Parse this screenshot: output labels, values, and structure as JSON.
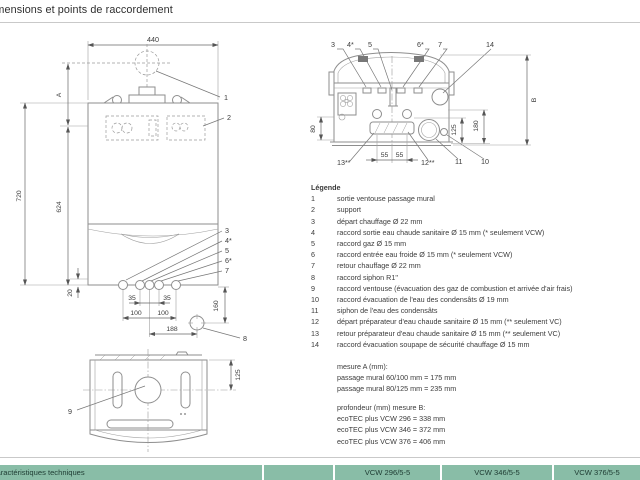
{
  "page": {
    "title": "Dimensions et points de raccordement"
  },
  "legend": {
    "heading": "Légende",
    "items": [
      {
        "num": "1",
        "text": "sortie ventouse passage mural"
      },
      {
        "num": "2",
        "text": "support"
      },
      {
        "num": "3",
        "text": "départ chauffage Ø 22 mm"
      },
      {
        "num": "4",
        "text": "raccord sortie eau chaude sanitaire Ø 15 mm (* seulement VCW)"
      },
      {
        "num": "5",
        "text": "raccord gaz Ø 15 mm"
      },
      {
        "num": "6",
        "text": "raccord entrée eau froide Ø 15 mm (* seulement VCW)"
      },
      {
        "num": "7",
        "text": "retour chauffage Ø 22 mm"
      },
      {
        "num": "8",
        "text": "raccord siphon R1\""
      },
      {
        "num": "9",
        "text": "raccord ventouse (évacuation des gaz de combustion et arrivée d'air frais)"
      },
      {
        "num": "10",
        "text": "raccord évacuation de l'eau des condensâts Ø 19 mm"
      },
      {
        "num": "11",
        "text": "siphon de l'eau des condensâts"
      },
      {
        "num": "12",
        "text": "départ préparateur d'eau chaude sanitaire Ø 15 mm (** seulement VC)"
      },
      {
        "num": "13",
        "text": "retour préparateur d'eau chaude sanitaire Ø 15 mm (** seulement VC)"
      },
      {
        "num": "14",
        "text": "raccord évacuation soupape de sécurité chauffage Ø 15 mm"
      }
    ]
  },
  "notes": {
    "measure_a_title": "mesure A (mm):",
    "measure_a_line1": "passage mural 60/100 mm = 175 mm",
    "measure_a_line2": "passage mural 80/125 mm = 235 mm",
    "measure_b_title": "profondeur (mm) mesure B:",
    "measure_b_line1": "ecoTEC plus VCW 296 = 338 mm",
    "measure_b_line2": "ecoTEC plus VCW 346 = 372 mm",
    "measure_b_line3": "ecoTEC plus VCW 376 = 406 mm"
  },
  "front_view": {
    "dim_width": "440",
    "dim_a": "A",
    "dim_720": "720",
    "dim_624": "624",
    "dim_20": "20",
    "dim_35a": "35",
    "dim_35b": "35",
    "dim_100a": "100",
    "dim_100b": "100",
    "dim_188": "188",
    "dim_160": "160",
    "callout_1": "1",
    "callout_2": "2",
    "callout_3": "3",
    "callout_4": "4*",
    "callout_5": "5",
    "callout_6": "6*",
    "callout_7": "7",
    "callout_8": "8"
  },
  "bottom_view": {
    "callout_3": "3",
    "callout_4": "4*",
    "callout_5": "5",
    "callout_6": "6*",
    "callout_7": "7",
    "callout_14": "14",
    "dim_b": "B",
    "dim_80": "80",
    "dim_125": "125",
    "dim_180": "180",
    "dim_55a": "55",
    "dim_55b": "55",
    "callout_13": "13**",
    "callout_12": "12**",
    "callout_11": "11",
    "callout_10": "10"
  },
  "top_view": {
    "callout_9": "9",
    "dim_125": "125"
  },
  "table": {
    "header_label": "Caractéristiques techniques",
    "columns": [
      "VCW 296/5-5",
      "VCW 346/5-5",
      "VCW 376/5-5"
    ]
  },
  "colors": {
    "table_header_bg": "#89bda7",
    "drawing_line": "#8e8e8e",
    "text": "#3b3b3b"
  }
}
